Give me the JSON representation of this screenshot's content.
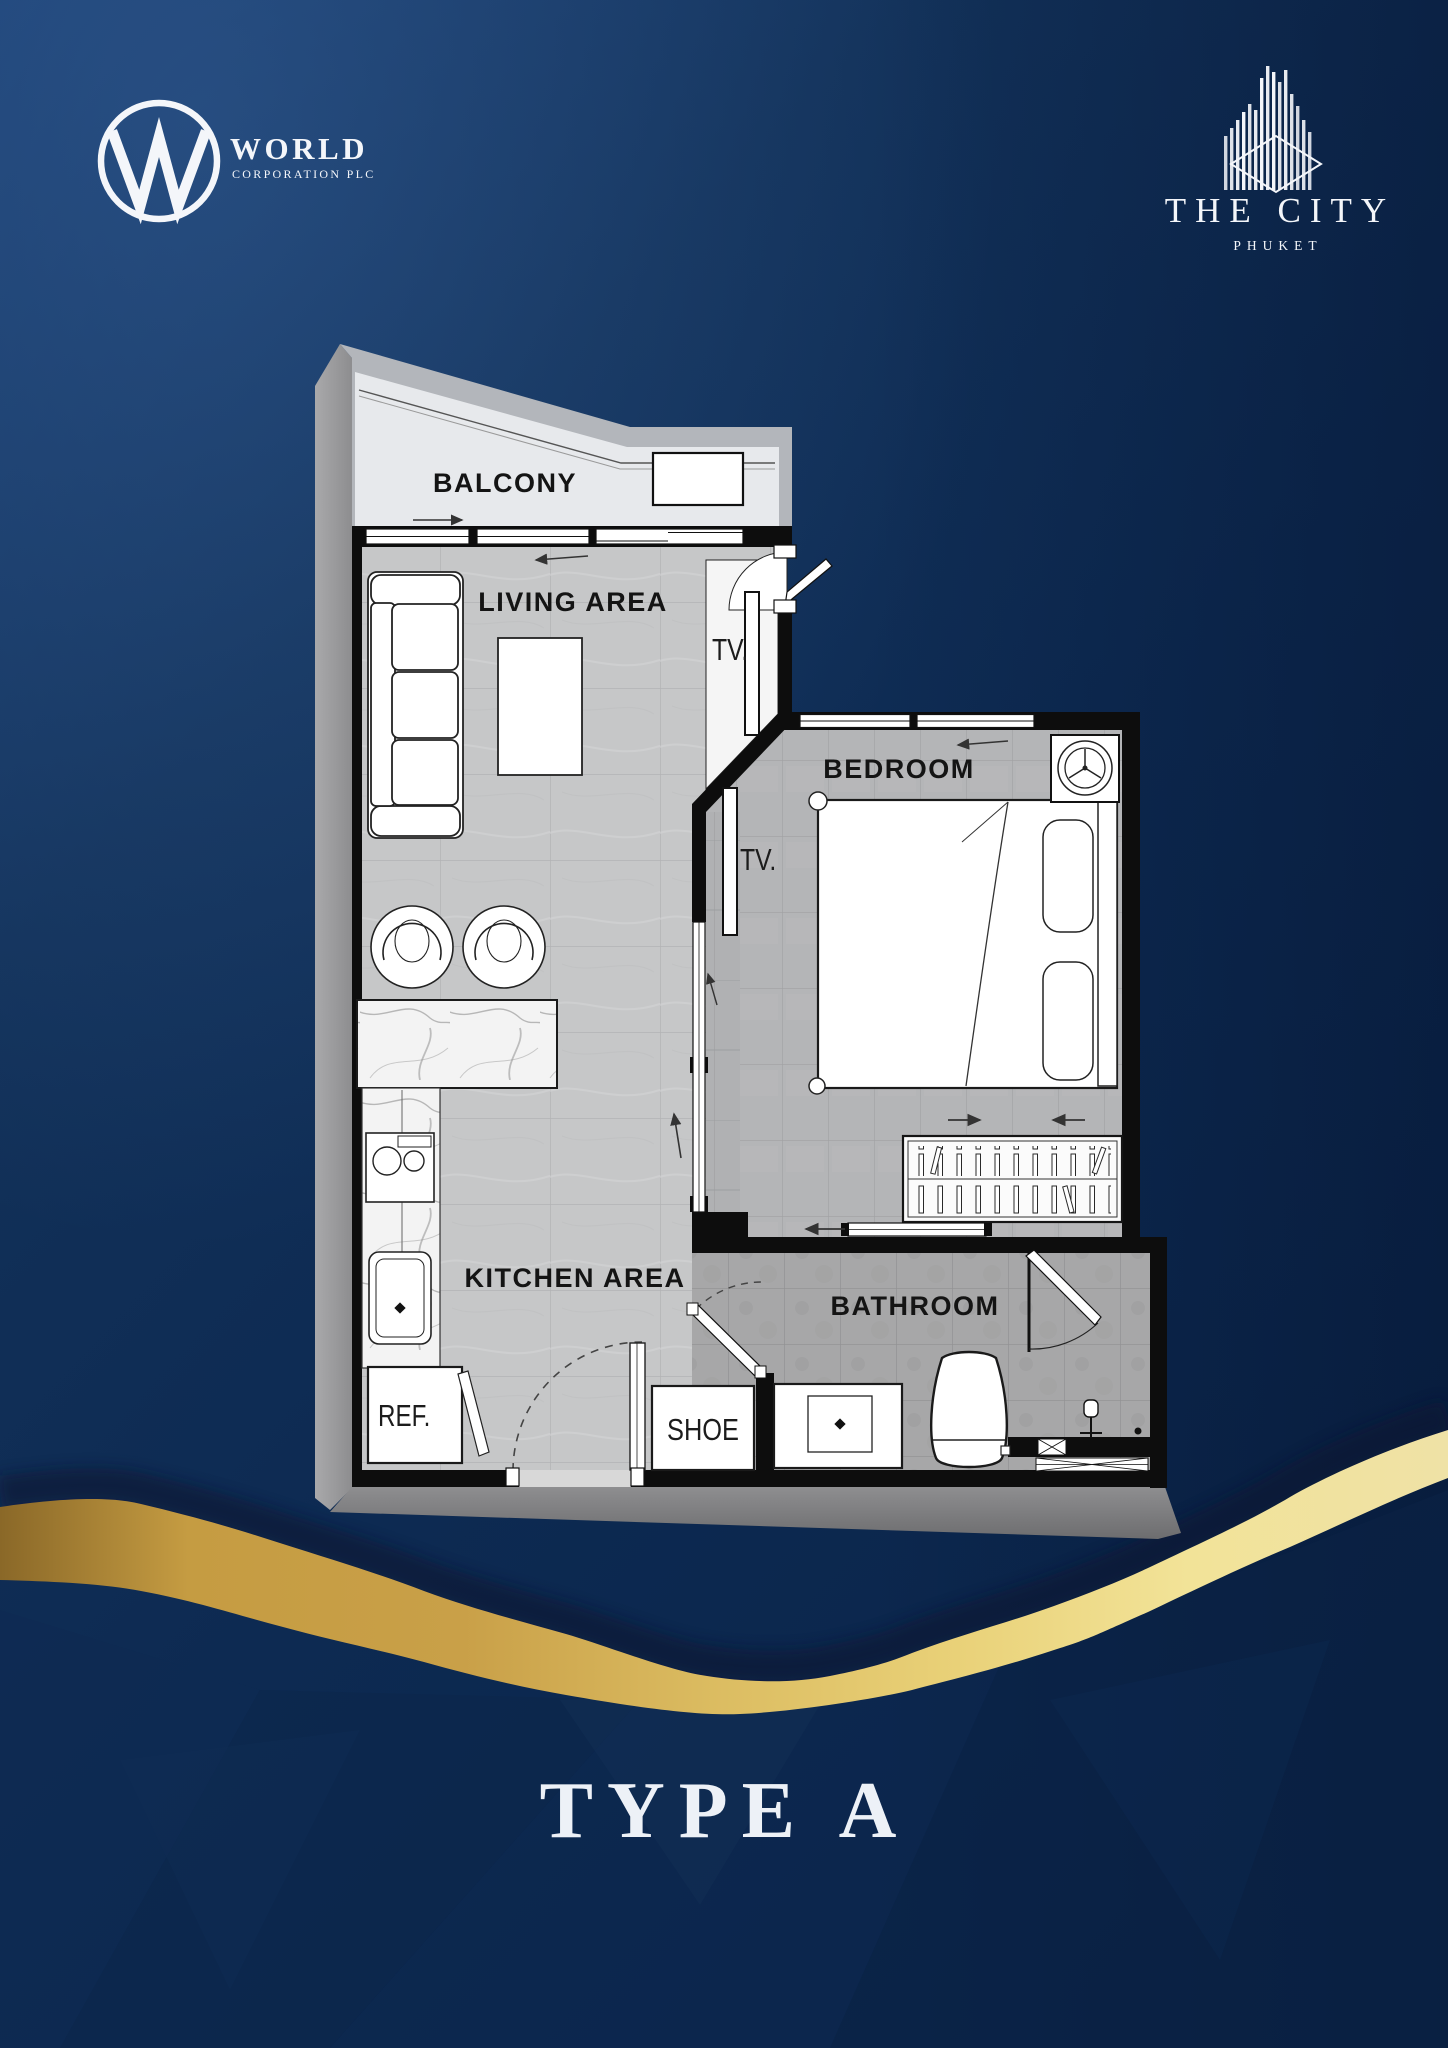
{
  "title": "TYPE A",
  "brand": {
    "world": {
      "monogram": "W",
      "name": "WORLD",
      "sub": "CORPORATION PLC"
    },
    "city": {
      "name": "THE CITY",
      "sub": "PHUKET"
    }
  },
  "plan": {
    "rooms": {
      "balcony": "BALCONY",
      "living": "LIVING AREA",
      "bedroom": "BEDROOM",
      "kitchen": "KITCHEN AREA",
      "bathroom": "BATHROOM"
    },
    "fixtures": {
      "tv_living": "TV.",
      "tv_bedroom": "TV.",
      "fridge": "REF.",
      "shoe": "SHOE"
    }
  },
  "colors": {
    "background_navy": "#0d2a52",
    "accent_gold": "#e8d075",
    "wall_black": "#0d0d0d",
    "floor_gray": "#c6c7c8"
  }
}
